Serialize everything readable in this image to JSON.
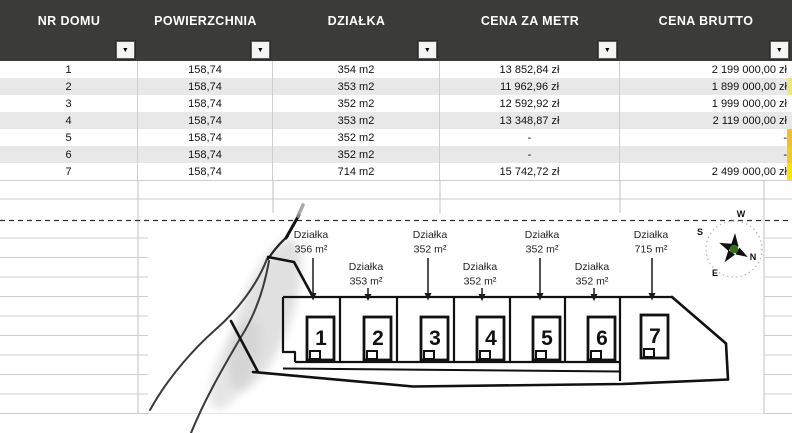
{
  "table": {
    "headers": [
      "NR DOMU",
      "POWIERZCHNIA",
      "DZIAŁKA",
      "CENA ZA METR",
      "CENA BRUTTO"
    ],
    "rows": [
      [
        "1",
        "158,74",
        "354 m2",
        "13 852,84 zł",
        "2 199 000,00 zł"
      ],
      [
        "2",
        "158,74",
        "353 m2",
        "11 962,96 zł",
        "1 899 000,00 zł"
      ],
      [
        "3",
        "158,74",
        "352 m2",
        "12 592,92 zł",
        "1 999 000,00 zł"
      ],
      [
        "4",
        "158,74",
        "353 m2",
        "13 348,87 zł",
        "2 119 000,00 zł"
      ],
      [
        "5",
        "158,74",
        "352 m2",
        "-",
        "-"
      ],
      [
        "6",
        "158,74",
        "352 m2",
        "-",
        "-"
      ],
      [
        "7",
        "158,74",
        "714 m2",
        "15 742,72 zł",
        "2 499 000,00 zł"
      ]
    ]
  },
  "icons": {
    "filter_dropdown": "▼"
  },
  "plan": {
    "plots": [
      {
        "label": "Działka",
        "area": "356 m²",
        "house": "1"
      },
      {
        "label": "Działka",
        "area": "353 m²",
        "house": "2"
      },
      {
        "label": "Działka",
        "area": "352 m²",
        "house": "3"
      },
      {
        "label": "Działka",
        "area": "352 m²",
        "house": "4"
      },
      {
        "label": "Działka",
        "area": "352 m²",
        "house": "5"
      },
      {
        "label": "Działka",
        "area": "352 m²",
        "house": "6"
      },
      {
        "label": "Działka",
        "area": "715 m²",
        "house": "7"
      }
    ],
    "compass": {
      "w": "W",
      "s": "S",
      "n": "N",
      "e": "E"
    }
  },
  "colors": {
    "header_bg": "#3b3b39",
    "row_alt": "#e8e8e8",
    "highlight_yellow": "#fbe311",
    "highlight_orange": "#f2bd3a",
    "compass_green": "#356f1f"
  }
}
